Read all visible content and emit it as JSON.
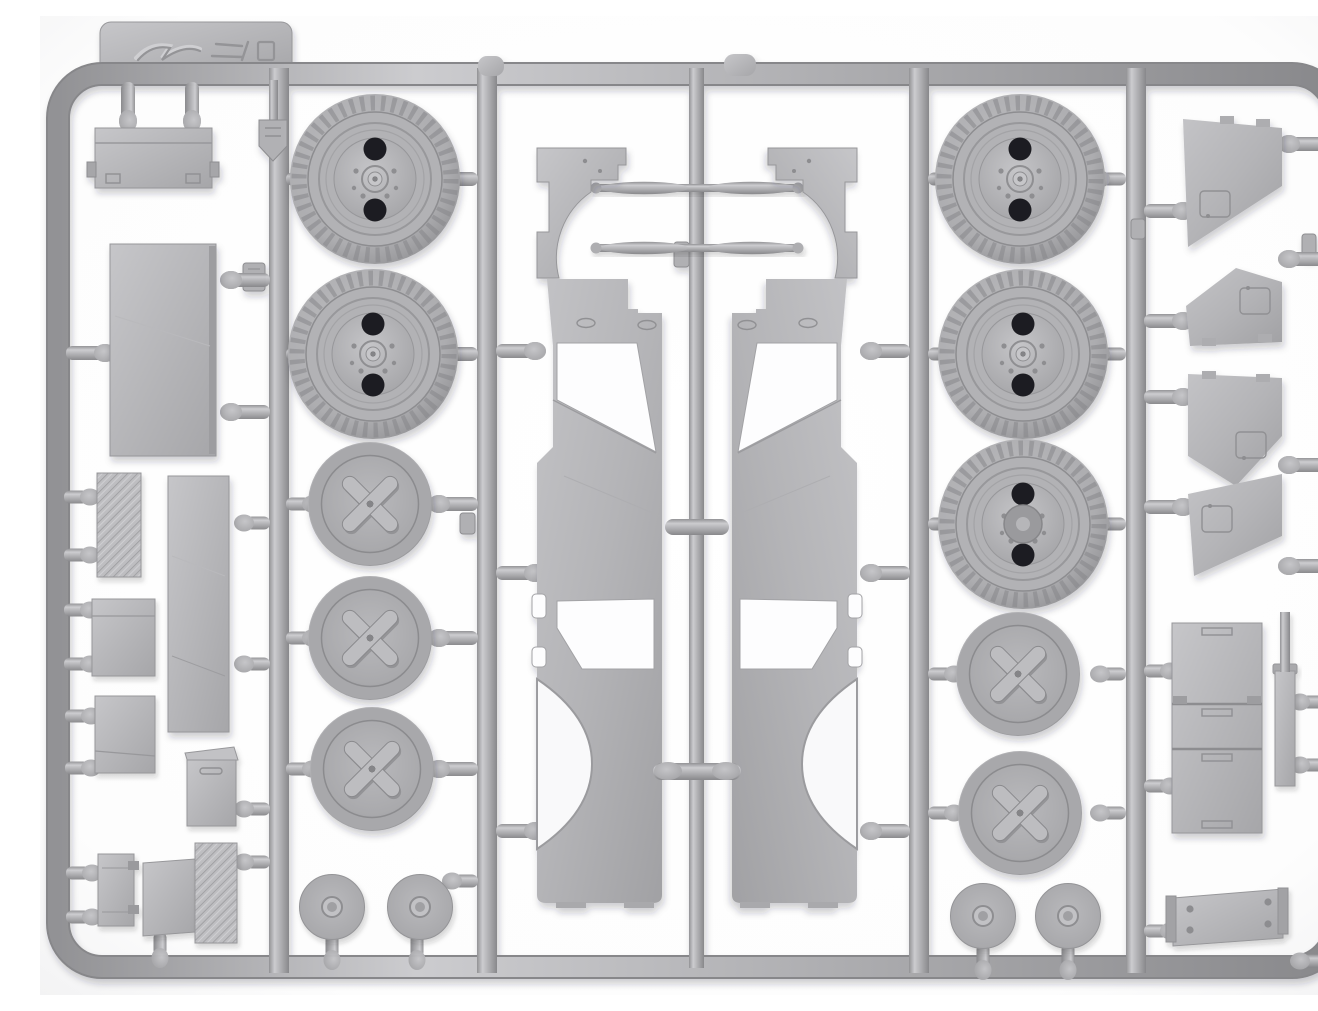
{
  "meta": {
    "type": "product-photograph",
    "subject": "Injection-molded plastic model kit sprue, light grey styrene, photographed on white",
    "alt": "Top-down photo of a rectangular grey plastic model kit sprue frame holding unassembled vehicle parts: treaded road wheels, X-spoke inner wheel halves, hub caps, two mirrored hull side panels with wheel-arch cutouts, fenders, axle rods, four door panels, stowage boxes, tread plates and small fittings, all attached to runners by short gates"
  },
  "palette": {
    "background": "#ffffff",
    "background_edge": "#f2f2f3",
    "plastic_base": "#b3b3b6",
    "plastic_highlight": "#d8d8db",
    "plastic_mid": "#a7a7aa",
    "plastic_shadow": "#8b8b8e",
    "plastic_dark": "#6f6f73",
    "hole_dark": "#1f1f22",
    "cast_shadow": "rgba(40,40,45,0.22)"
  },
  "sprue": {
    "frame_shape": "rounded rectangle",
    "vertical_runners": 5,
    "tab_marking": "embossed manufacturer logo (illegible)",
    "mold_stamp": "small shield-shaped stamp tag",
    "part_number_tags": "tiny embossed number chips (illegible)"
  },
  "parts": {
    "labels": {
      "frame": "Sprue frame and runners",
      "tab": "Sprue tab with embossed manufacturer logo",
      "shield_tag": "Shield-shaped mold stamp tag",
      "number_tag": "Embossed part-number chip",
      "gate": "Sprue gate",
      "tire": "Treaded road wheel",
      "xwheel": "X-spoke inner wheel half",
      "disc": "Wheel hub cap disc",
      "panel_left": "Hull side panel (left) with wheel arch and door opening",
      "panel_right": "Hull side panel (right) with wheel arch and door opening",
      "fender": "Front fender with wheel-well arch",
      "axle_rod": "Axle rod",
      "door_panel": "Door / windscreen panel",
      "toolbox": "Tool box with latches",
      "big_panel": "Large floor panel",
      "tread_plate": "Anti-slip tread plate",
      "narrow_panel": "Long narrow panel",
      "small_box": "Stowage box",
      "lidded_box": "Lidded stowage box",
      "clasp_box": "Small box with clasps",
      "knurled_plate": "Textured tread plate",
      "locker_stack": "Stacked locker / bin fronts",
      "strip": "Narrow mounting strip",
      "riveted_plate": "Mounting plate with rivets"
    },
    "counts": {
      "treaded_road_wheels": 5,
      "x_spoke_wheels": 5,
      "hub_cap_discs": 4,
      "hull_side_panels": 2,
      "fenders": 2,
      "axle_rods": 2,
      "door_panels": 4,
      "tread_plates": 2,
      "stowage_boxes_and_panels": 9,
      "locker_stacks": 1,
      "riveted_plates": 1
    }
  }
}
